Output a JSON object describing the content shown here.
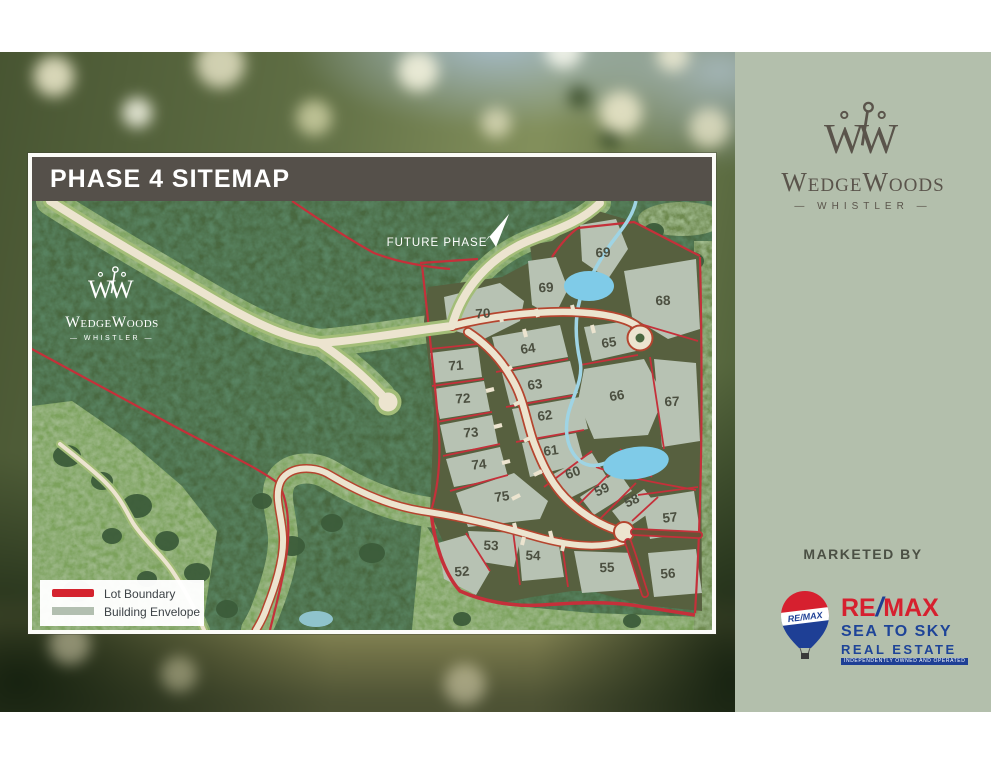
{
  "page": {
    "background": "#ffffff"
  },
  "map_panel": {
    "title": "PHASE 4 SITEMAP",
    "future_phase_label": "FUTURE PHASE",
    "watermark": {
      "name": "WedgeWoods",
      "tagline": "— WHISTLER —"
    },
    "legend": {
      "items": [
        {
          "label": "Lot Boundary",
          "swatch": "#d4232e"
        },
        {
          "label": "Building Envelope",
          "swatch": "#b2bfb0"
        }
      ]
    },
    "lots": [
      {
        "number": "52",
        "x": 430,
        "y": 371
      },
      {
        "number": "53",
        "x": 459,
        "y": 345
      },
      {
        "number": "54",
        "x": 501,
        "y": 355
      },
      {
        "number": "55",
        "x": 575,
        "y": 367
      },
      {
        "number": "56",
        "x": 636,
        "y": 373
      },
      {
        "number": "57",
        "x": 638,
        "y": 317
      },
      {
        "number": "58",
        "x": 600,
        "y": 300
      },
      {
        "number": "59",
        "x": 570,
        "y": 289
      },
      {
        "number": "60",
        "x": 541,
        "y": 272
      },
      {
        "number": "61",
        "x": 519,
        "y": 250
      },
      {
        "number": "62",
        "x": 513,
        "y": 215
      },
      {
        "number": "63",
        "x": 503,
        "y": 184
      },
      {
        "number": "64",
        "x": 496,
        "y": 148
      },
      {
        "number": "65",
        "x": 577,
        "y": 142
      },
      {
        "number": "66",
        "x": 585,
        "y": 195
      },
      {
        "number": "67",
        "x": 640,
        "y": 201
      },
      {
        "number": "68",
        "x": 631,
        "y": 100
      },
      {
        "number": "69",
        "x": 571,
        "y": 52
      },
      {
        "number": "69",
        "x": 514,
        "y": 87
      },
      {
        "number": "70",
        "x": 451,
        "y": 113
      },
      {
        "number": "71",
        "x": 424,
        "y": 165
      },
      {
        "number": "72",
        "x": 431,
        "y": 198
      },
      {
        "number": "73",
        "x": 439,
        "y": 232
      },
      {
        "number": "74",
        "x": 447,
        "y": 264
      },
      {
        "number": "75",
        "x": 470,
        "y": 296
      }
    ],
    "colors": {
      "forest": "#4a673f",
      "meadow": "#7ca25c",
      "olive": "#57603f",
      "envelope": "#b7c2b3",
      "road": "#ece4cf",
      "road_halo": "#a3bd78",
      "road_edge": "#b5452f",
      "boundary": "#c5303a",
      "water": "#7fcbe8",
      "header": "#55504a",
      "lot_label": "#4b4f40"
    }
  },
  "sidebar": {
    "logo": {
      "name": "WedgeWoods",
      "tagline": "— WHISTLER —"
    },
    "marketed_by_label": "MARKETED BY",
    "remax": {
      "balloon_label": "RE/MAX",
      "brand_prefix": "RE",
      "brand_slash": "/",
      "brand_suffix": "MAX",
      "line2": "SEA TO SKY",
      "line3": "REAL ESTATE",
      "disclaimer": "INDEPENDENTLY OWNED AND OPERATED",
      "red": "#d6202f",
      "blue": "#1e4498"
    }
  }
}
